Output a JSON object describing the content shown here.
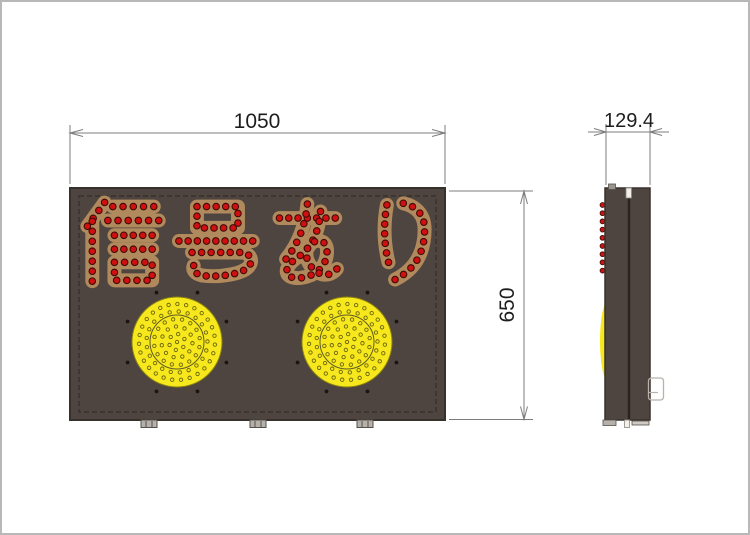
{
  "drawing": {
    "sign_text": "信号あり",
    "dimensions": {
      "width_label": "1050",
      "height_label": "650",
      "depth_label": "129.4"
    },
    "lights": {
      "count": 2
    },
    "colors": {
      "board": "#4f4540",
      "board_border": "#38302b",
      "inner_border": "#332c27",
      "stroke_tan": "#b08a5c",
      "led_red": "#d01010",
      "led_ring": "#3f0a06",
      "lens_yellow": "#f6e81c",
      "lens_edge": "#8e850f",
      "lens_dot": "#6b640e",
      "lens_inner_ring": "#5f5a2a",
      "mount_dot": "#1a1512",
      "line_gray": "#7d7d7d",
      "text_dark": "#1e1e1e",
      "fitting_gray": "#b5b0aa",
      "fitting_edge": "#55504a",
      "seam_dark": "#2a2420",
      "hanger_white": "#f2efe9",
      "bracket_gray": "#b7b2ac"
    }
  }
}
